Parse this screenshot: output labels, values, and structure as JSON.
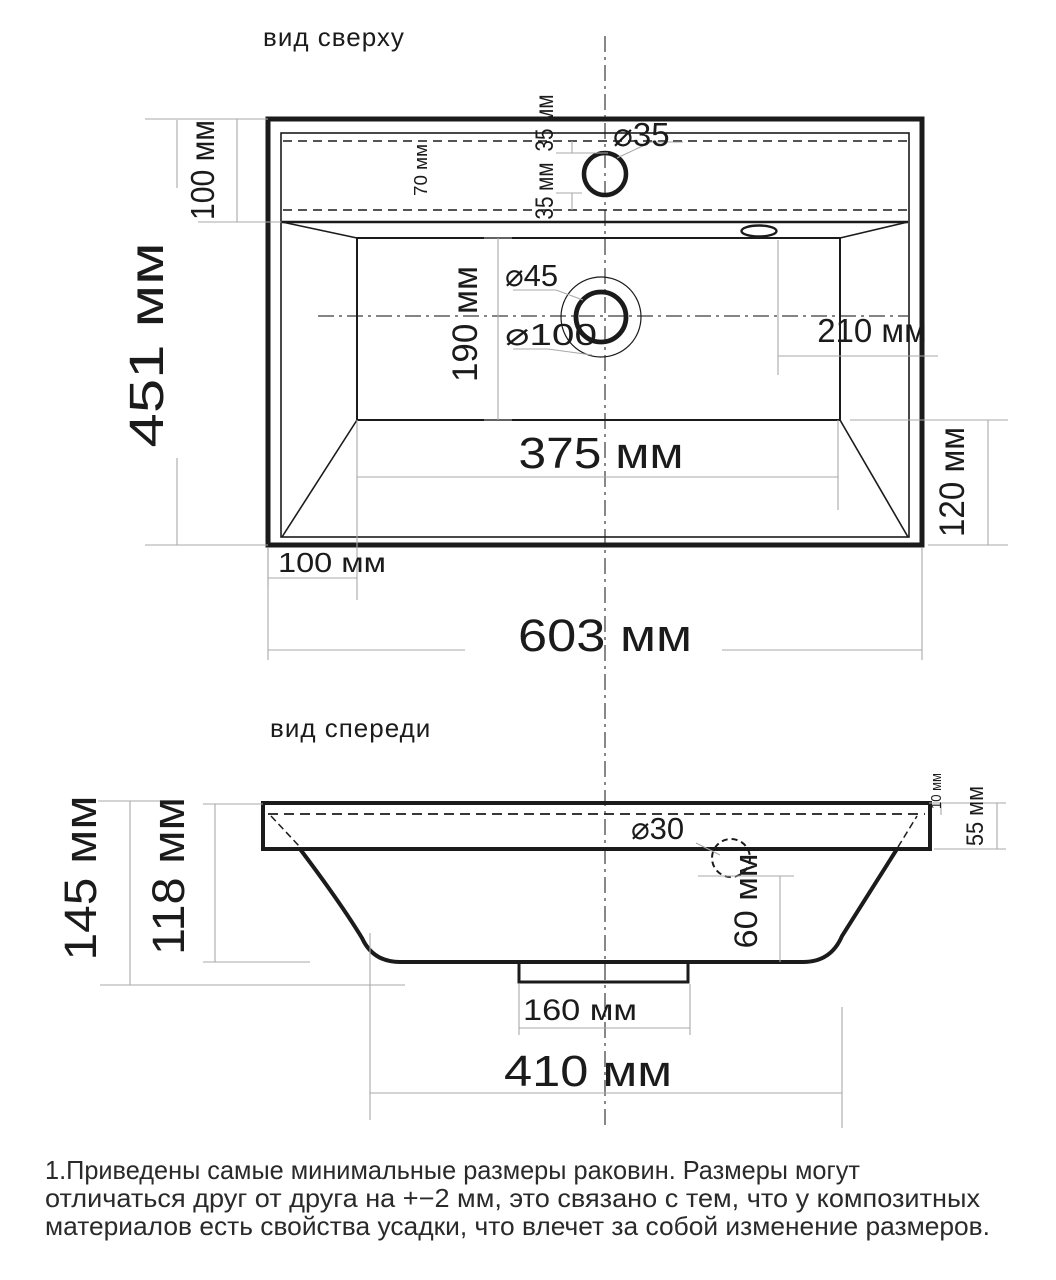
{
  "document": {
    "background": "#ffffff",
    "line_color": "#1b1b1b",
    "dim_line_color": "#a8a8a8"
  },
  "top_view": {
    "title": "вид сверху",
    "labels": {
      "overall_depth": "451 мм",
      "back_ledge_depth": "100 мм",
      "ledge_inner_depth": "70 мм",
      "faucet_offset_upper": "35 мм",
      "faucet_offset_lower": "35 мм",
      "faucet_hole_diameter": "⌀35",
      "drain_hole_diameter": "⌀45",
      "drain_recess_diameter": "⌀100",
      "bowl_floor_depth": "190 мм",
      "drain_side_offset": "210 мм",
      "bowl_floor_width": "375 мм",
      "front_corner_offset": "100 мм",
      "overall_width": "603 мм",
      "side_slope_width": "120 мм"
    }
  },
  "front_view": {
    "title": "вид спереди",
    "labels": {
      "overall_height": "145 мм",
      "bowl_height": "118 мм",
      "overflow_hole_diameter": "⌀30",
      "overflow_to_bottom": "60 мм",
      "rim_top_thickness": "10 мм",
      "rim_height": "55 мм",
      "drain_flange_width": "160 мм",
      "bottom_width": "410 мм"
    }
  },
  "footnote": {
    "line1": "1.Приведены самые минимальные размеры раковин. Размеры могут",
    "line2": "отличаться друг от друга на +−2 мм, это связано с тем, что у композитных",
    "line3": "материалов есть свойства усадки, что влечет за собой изменение размеров."
  }
}
